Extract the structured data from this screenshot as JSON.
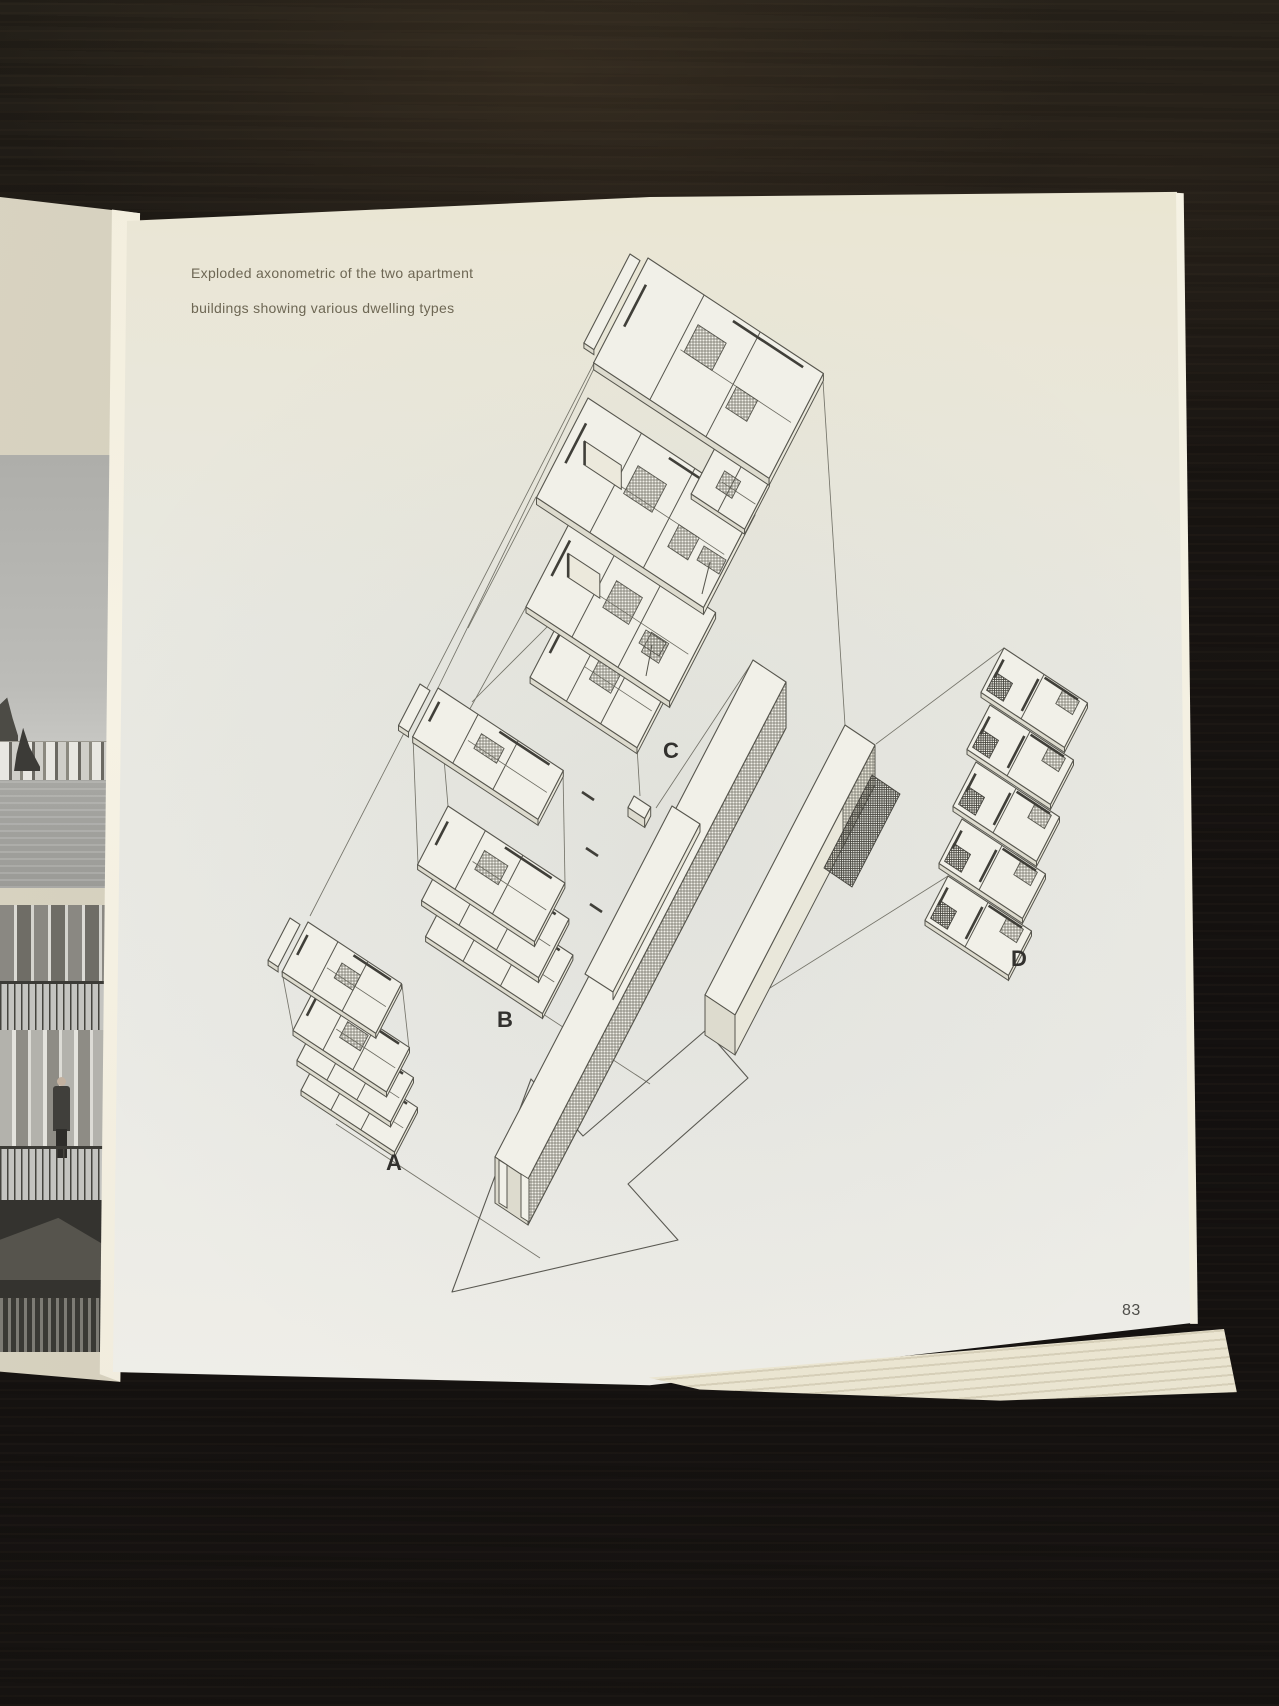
{
  "book_page": {
    "caption": {
      "line1": "Exploded axonometric of the two apartment",
      "line2": "buildings showing various dwelling types"
    },
    "figure_labels": {
      "a": "A",
      "b": "B",
      "c": "C",
      "d": "D"
    },
    "page_number": "83"
  },
  "colors": {
    "paper": "#e9e8e1",
    "drawing_ink": "#57564e",
    "caption_text": "#6e6754",
    "label_text": "#32312e",
    "table_wood": "#171310"
  }
}
